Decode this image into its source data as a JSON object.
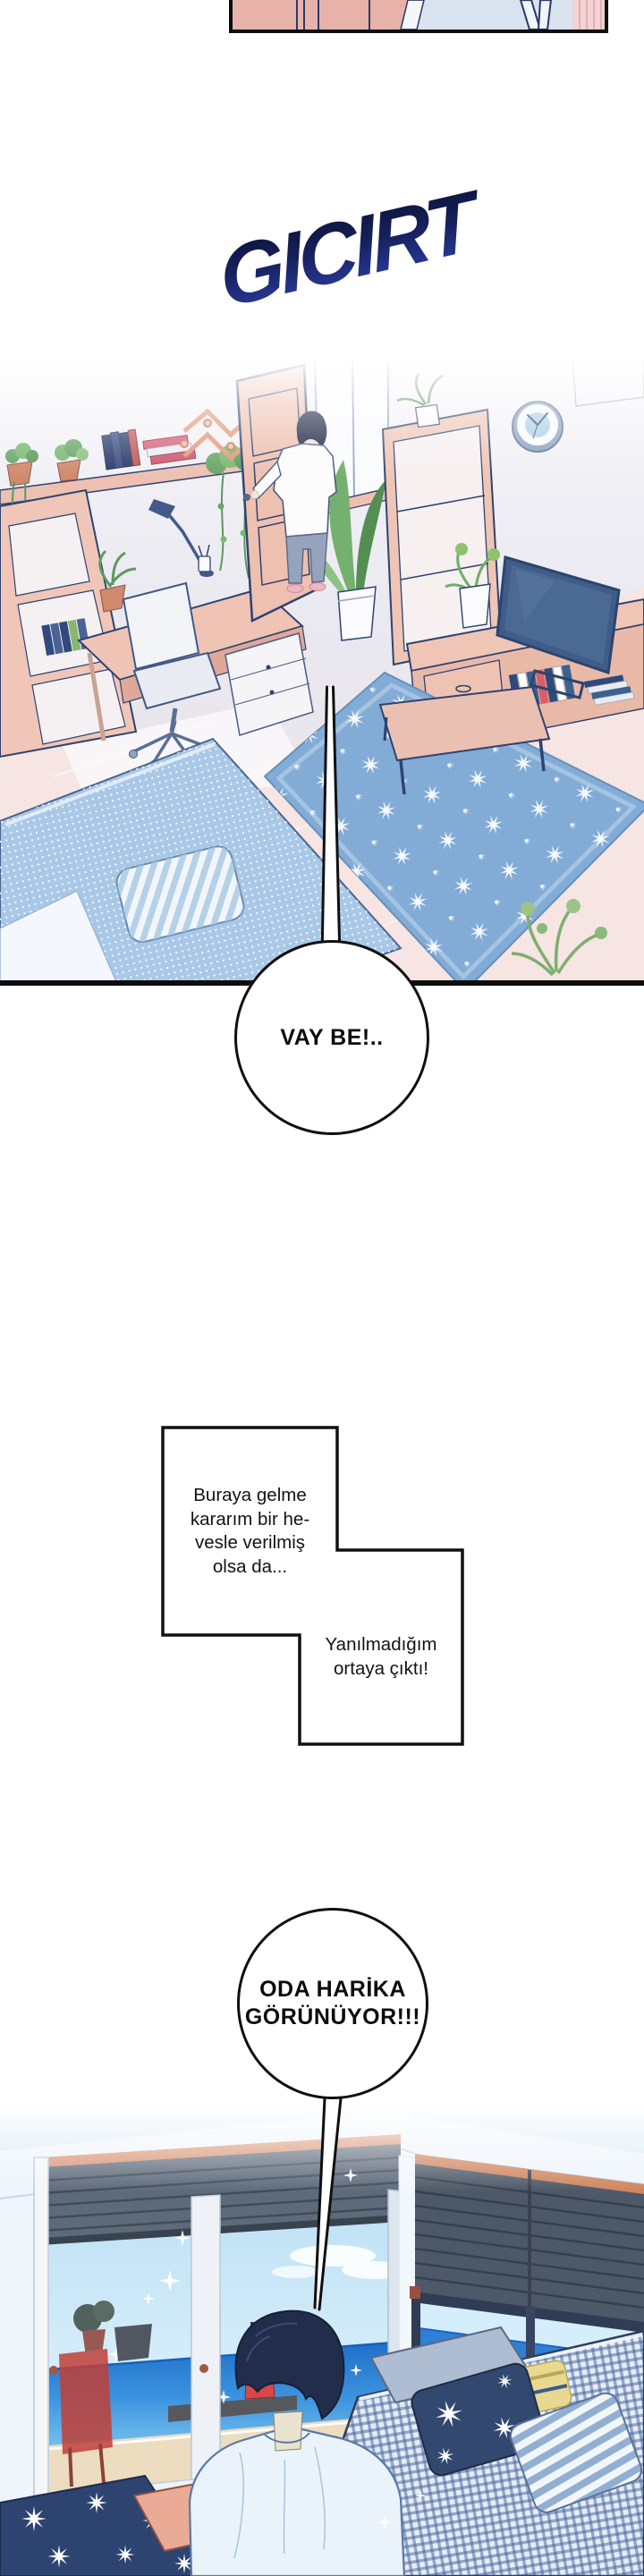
{
  "page": {
    "background": "#ffffff"
  },
  "sfx": {
    "text": "GICIRT",
    "gradient_top": "#0d1130",
    "gradient_bottom": "#2e41ab"
  },
  "panels": {
    "top_strip": {
      "alt": "cropped bottom edge of previous panel"
    },
    "room": {
      "alt": "tilted view of bright pastel bedroom, man in white t-shirt holding the open door"
    },
    "seaside": {
      "alt": "man seen from behind looking at the sea through large bedroom windows"
    }
  },
  "bubbles": {
    "vay": {
      "text": "VAY BE!.."
    },
    "caption": {
      "part1": {
        "lines": [
          "Buraya gelme",
          "kararım bir he-",
          "vesle verilmiş",
          "olsa da..."
        ]
      },
      "part2": {
        "lines": [
          "Yanılmadığım",
          "ortaya çıktı!"
        ]
      }
    },
    "oda": {
      "lines": [
        "ODA HARİKA",
        "GÖRÜNÜYOR!!!"
      ]
    }
  },
  "colors": {
    "outline_navy": "#2e4370",
    "furniture_salmon": "#efc5b6",
    "rug_blue": "#82abd6",
    "bed_blue": "#a9c8e7",
    "sea_blue": "#2f80d5",
    "night_navy": "#2e4470"
  }
}
